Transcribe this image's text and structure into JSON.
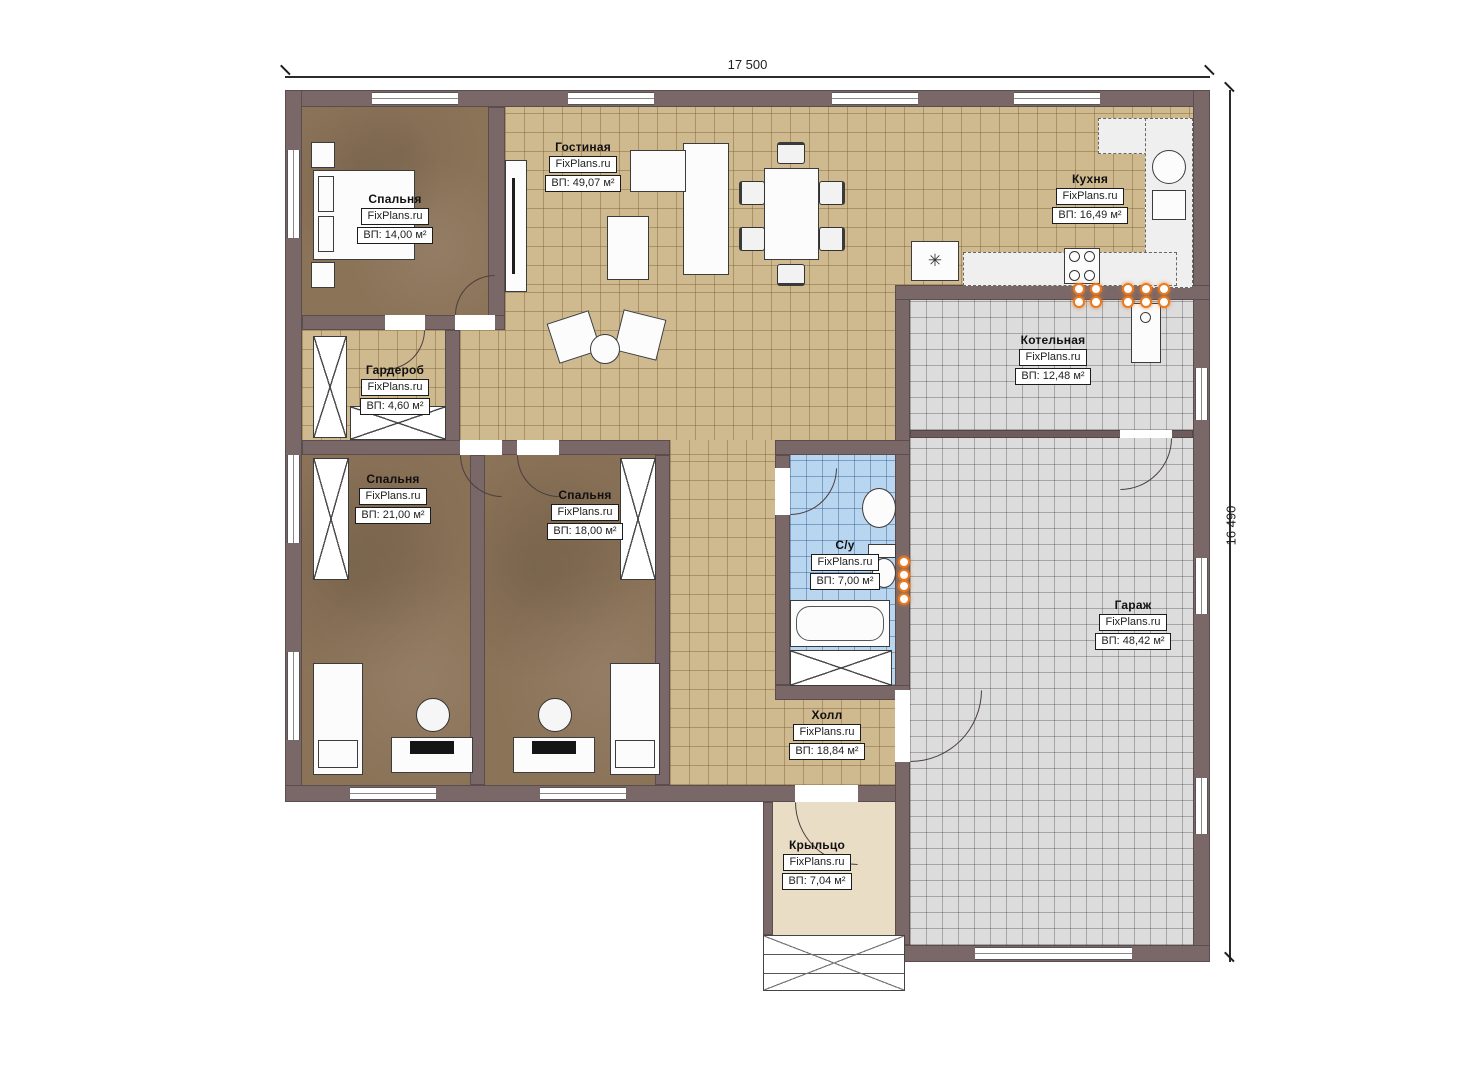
{
  "dimensions": {
    "top": "17 500",
    "right": "16 490"
  },
  "rooms": [
    {
      "id": "bedroom-1",
      "name": "Спальня",
      "watermark": "FixPlans.ru",
      "area": "ВП: 14,00 м²"
    },
    {
      "id": "living-room",
      "name": "Гостиная",
      "watermark": "FixPlans.ru",
      "area": "ВП: 49,07 м²"
    },
    {
      "id": "kitchen",
      "name": "Кухня",
      "watermark": "FixPlans.ru",
      "area": "ВП: 16,49 м²"
    },
    {
      "id": "wardrobe",
      "name": "Гардероб",
      "watermark": "FixPlans.ru",
      "area": "ВП: 4,60 м²"
    },
    {
      "id": "boiler-room",
      "name": "Котельная",
      "watermark": "FixPlans.ru",
      "area": "ВП: 12,48 м²"
    },
    {
      "id": "bedroom-2",
      "name": "Спальня",
      "watermark": "FixPlans.ru",
      "area": "ВП: 21,00 м²"
    },
    {
      "id": "bedroom-3",
      "name": "Спальня",
      "watermark": "FixPlans.ru",
      "area": "ВП: 18,00 м²"
    },
    {
      "id": "bathroom",
      "name": "С/у",
      "watermark": "FixPlans.ru",
      "area": "ВП: 7,00 м²"
    },
    {
      "id": "garage",
      "name": "Гараж",
      "watermark": "FixPlans.ru",
      "area": "ВП: 48,42 м²"
    },
    {
      "id": "hall",
      "name": "Холл",
      "watermark": "FixPlans.ru",
      "area": "ВП: 18,84 м²"
    },
    {
      "id": "porch",
      "name": "Крыльцо",
      "watermark": "FixPlans.ru",
      "area": "ВП: 7,04 м²"
    }
  ],
  "symbols": {
    "fridge": "✳"
  },
  "colors": {
    "wall": "#7a6868",
    "floor_tile_beige": "#cfb98f",
    "floor_bedroom_brown": "#8b7358",
    "floor_gray_tile": "#dcdcdc",
    "floor_bath_blue": "#b9d6f0",
    "floor_porch": "#e9ddc6",
    "radiator_orange": "#e87a22"
  }
}
